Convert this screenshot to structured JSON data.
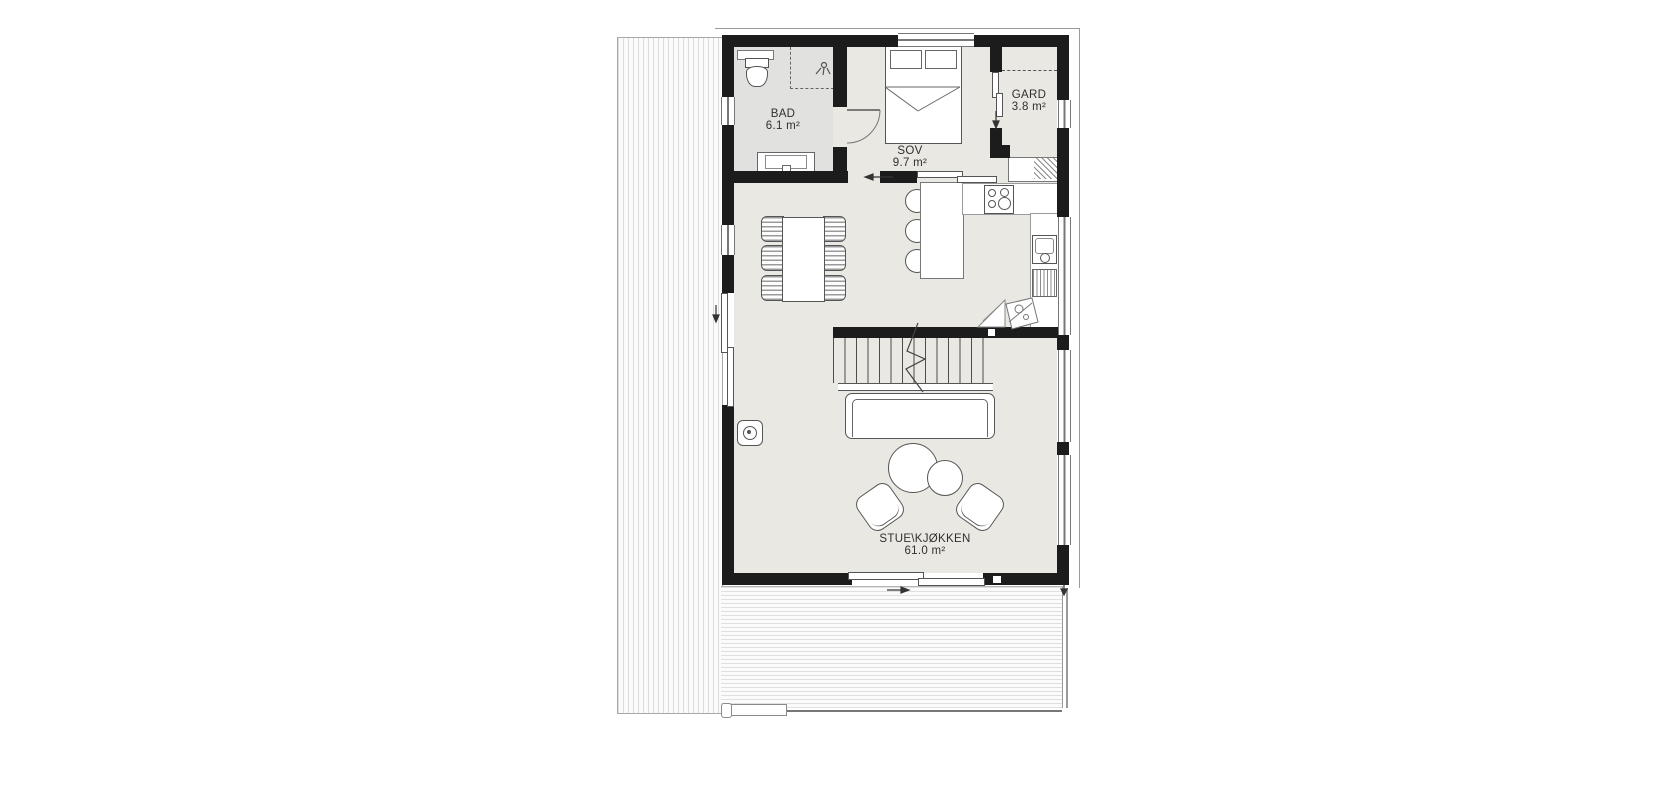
{
  "plan": {
    "title": "floor-plan",
    "rooms": [
      {
        "id": "bad",
        "label": "BAD",
        "area": "6.1 m²"
      },
      {
        "id": "sov",
        "label": "SOV",
        "area": "9.7 m²"
      },
      {
        "id": "gard",
        "label": "GARD",
        "area": "3.8 m²"
      },
      {
        "id": "stue_kjokken",
        "label": "STUE\\KJØKKEN",
        "area": "61.0 m²"
      }
    ],
    "colors": {
      "wall": "#1c1c1c",
      "floor": "#eae8e2",
      "bath_floor": "#e1e1df",
      "furniture_line": "#555555",
      "deck_line": "#dcdcdc"
    },
    "icons": [
      "toilet-icon",
      "shower-icon",
      "sink-vanity-icon",
      "bed-icon",
      "cooktop-icon",
      "kitchen-sink-icon",
      "wood-stove-icon",
      "stairs-icon",
      "sofa-icon",
      "armchair-icon",
      "dining-table-icon",
      "bar-stool-icon",
      "direction-arrow-icon"
    ]
  }
}
